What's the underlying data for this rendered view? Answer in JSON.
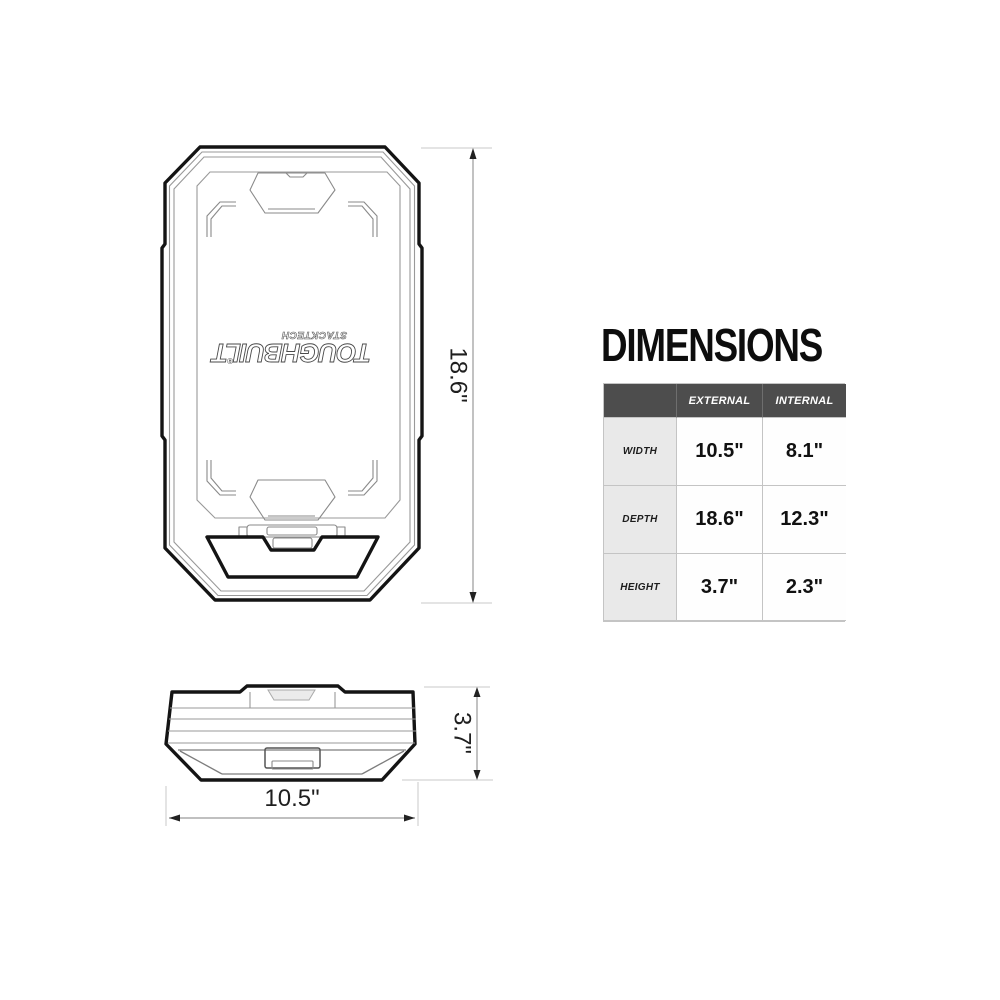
{
  "title": "DIMENSIONS",
  "table": {
    "col_headers": {
      "external": "EXTERNAL",
      "internal": "INTERNAL"
    },
    "rows": [
      {
        "label": "WIDTH",
        "external": "10.5\"",
        "internal": "8.1\""
      },
      {
        "label": "DEPTH",
        "external": "18.6\"",
        "internal": "12.3\""
      },
      {
        "label": "HEIGHT",
        "external": "3.7\"",
        "internal": "2.3\""
      }
    ]
  },
  "drawings": {
    "logo": {
      "brand": "TOUGHBUILT",
      "series": "STACKTECH",
      "reg_mark": "®"
    },
    "top_view": {
      "depth_label": "18.6\""
    },
    "side_view": {
      "height_label": "3.7\"",
      "width_label": "10.5\""
    }
  },
  "colors": {
    "header_bg": "#4d4d4d",
    "header_text": "#ffffff",
    "label_cell_bg": "#e9e9e9",
    "grid_border": "#c4c4c4",
    "line_dark": "#141414",
    "line_light": "#999999"
  }
}
